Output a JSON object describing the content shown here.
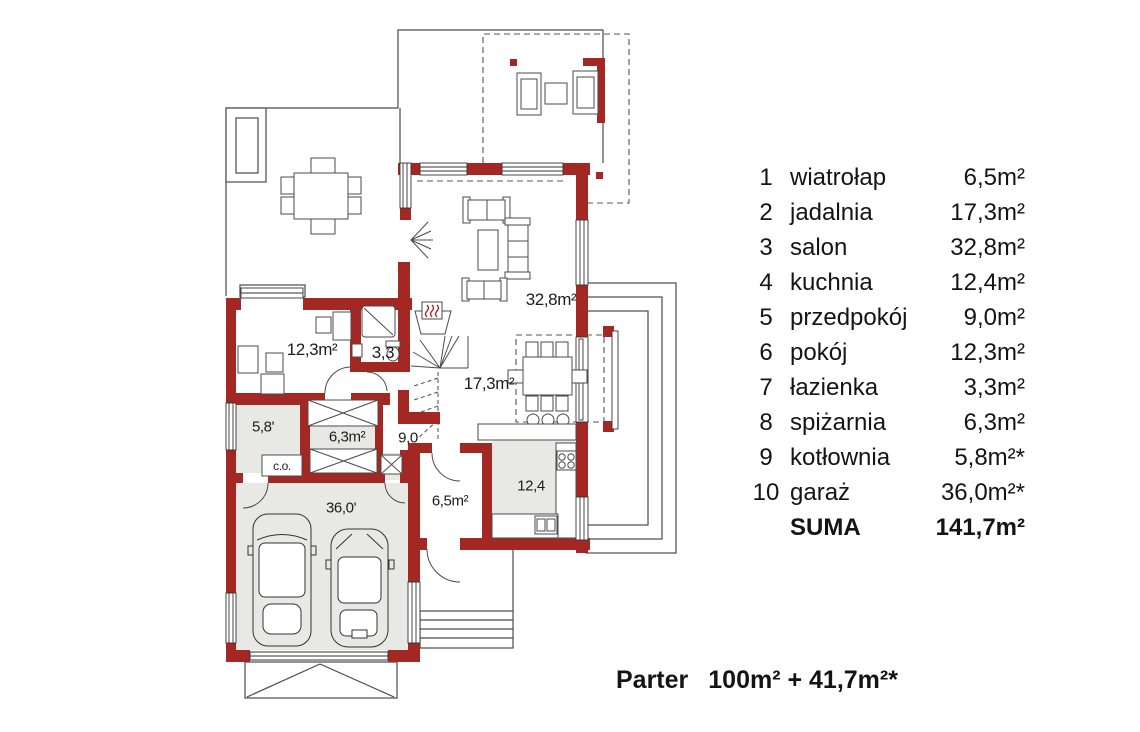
{
  "colors": {
    "wall": "#A32723",
    "floor_gray": "#E8E8E5",
    "line_dark": "#3C3C3C"
  },
  "legend": {
    "rows": [
      {
        "num": "1",
        "name": "wiatrołap",
        "area": "6,5m²"
      },
      {
        "num": "2",
        "name": "jadalnia",
        "area": "17,3m²"
      },
      {
        "num": "3",
        "name": "salon",
        "area": "32,8m²"
      },
      {
        "num": "4",
        "name": "kuchnia",
        "area": "12,4m²"
      },
      {
        "num": "5",
        "name": "przedpokój",
        "area": "9,0m²"
      },
      {
        "num": "6",
        "name": "pokój",
        "area": "12,3m²"
      },
      {
        "num": "7",
        "name": "łazienka",
        "area": "3,3m²"
      },
      {
        "num": "8",
        "name": "spiżarnia",
        "area": "6,3m²"
      },
      {
        "num": "9",
        "name": "kotłownia",
        "area": "5,8m²*"
      },
      {
        "num": "10",
        "name": "garaż",
        "area": "36,0m²*"
      }
    ],
    "total": {
      "label": "SUMA",
      "area": "141,7m²"
    }
  },
  "caption": {
    "floor_label": "Parter",
    "area_text": "100m² + 41,7m²*"
  },
  "plan": {
    "labels": [
      {
        "id": "pokoj",
        "text": "12,3m²"
      },
      {
        "id": "lazienka",
        "text": "3,3"
      },
      {
        "id": "jadalnia",
        "text": "17,3m²"
      },
      {
        "id": "salon",
        "text": "32,8m²"
      },
      {
        "id": "kotlownia",
        "text": "5,8'"
      },
      {
        "id": "spizarnia",
        "text": "6,3m²"
      },
      {
        "id": "przedpokoj",
        "text": "9,0"
      },
      {
        "id": "garaz",
        "text": "36,0'"
      },
      {
        "id": "wiatrolap",
        "text": "6,5m²"
      },
      {
        "id": "kuchnia",
        "text": "12,4"
      },
      {
        "id": "co",
        "text": "c.o."
      }
    ]
  }
}
